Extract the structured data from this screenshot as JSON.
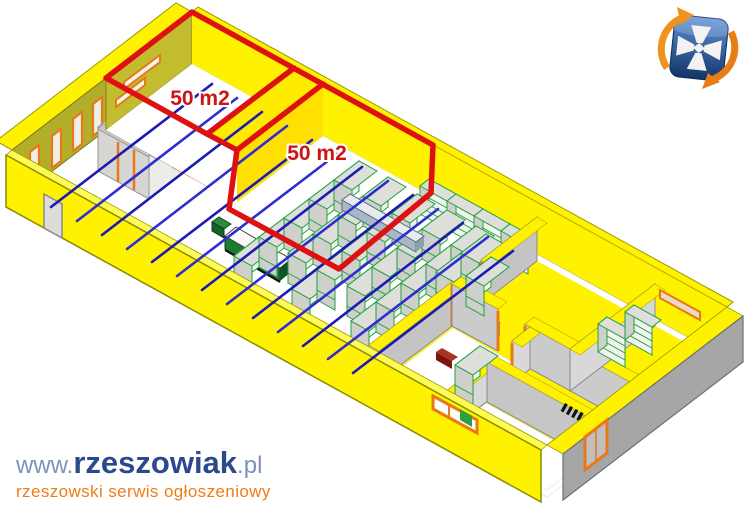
{
  "canvas": {
    "width": 745,
    "height": 514
  },
  "plan": {
    "room_labels": [
      "50 m2",
      "50 m2"
    ]
  },
  "branding": {
    "watermark": {
      "prefix": "www.",
      "name": "rzeszowiak",
      "suffix": ".pl",
      "tagline": "rzeszowski serwis ogłoszeniowy"
    },
    "logo_name": "rzeszowiak-shield-logo"
  },
  "palette": {
    "wall_yellow": "#FFF200",
    "outline_red": "#DD1111",
    "beam_blue": "#2222CC",
    "shelf_green": "#1FA23C",
    "frame_orange": "#E87818",
    "wall_gray": "#A6A6A6",
    "olive_wall": "#B2AE2A",
    "freezer_blue": "#88C4EE",
    "brand_navy": "#2B4A8E",
    "brand_light_blue": "#7B93BC",
    "brand_orange": "#EE7D18"
  }
}
